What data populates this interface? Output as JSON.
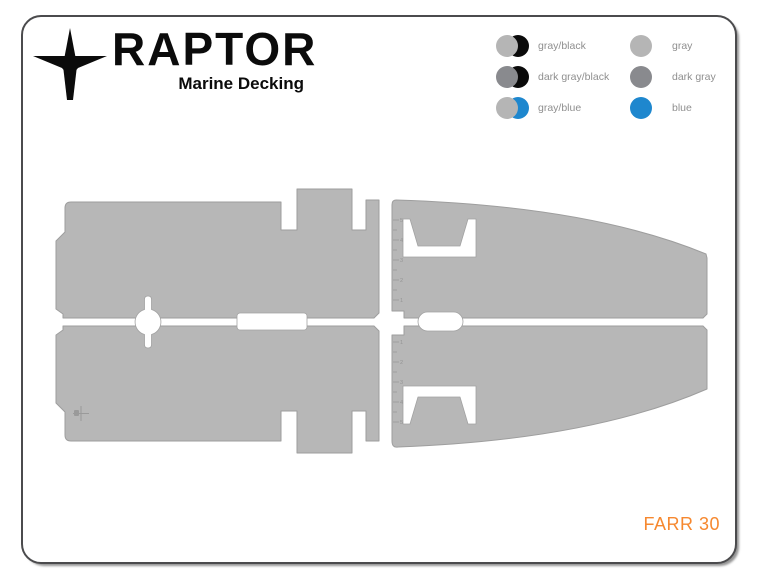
{
  "logo": {
    "brand": "RAPTOR",
    "tagline": "Marine Decking",
    "icon": "raptor-bird"
  },
  "legend": {
    "items": [
      {
        "label": "gray/black",
        "swatch": [
          "gray",
          "black"
        ]
      },
      {
        "label": "gray",
        "swatch": [
          "gray"
        ]
      },
      {
        "label": "dark gray/black",
        "swatch": [
          "dark_gray",
          "black"
        ]
      },
      {
        "label": "dark gray",
        "swatch": [
          "dark_gray"
        ]
      },
      {
        "label": "gray/blue",
        "swatch": [
          "gray",
          "blue"
        ]
      },
      {
        "label": "blue",
        "swatch": [
          "blue"
        ]
      }
    ],
    "colors": {
      "gray": "#b5b5b5",
      "dark_gray": "#898a8e",
      "black": "#0a0a0a",
      "blue": "#1e87ce",
      "label_text": "#8f8f8f"
    }
  },
  "diagram": {
    "model_label": "FARR 30",
    "model_label_color": "#f6882f",
    "deck_fill": "#b7b7b7",
    "deck_stroke": "#9e9e9e",
    "ruler_top": [
      "5",
      "4",
      "3",
      "2",
      "1"
    ],
    "ruler_bottom": [
      "1",
      "2",
      "3",
      "4",
      "5"
    ]
  },
  "page": {
    "frame_border_color": "#4b4b4d",
    "background": "#ffffff"
  }
}
